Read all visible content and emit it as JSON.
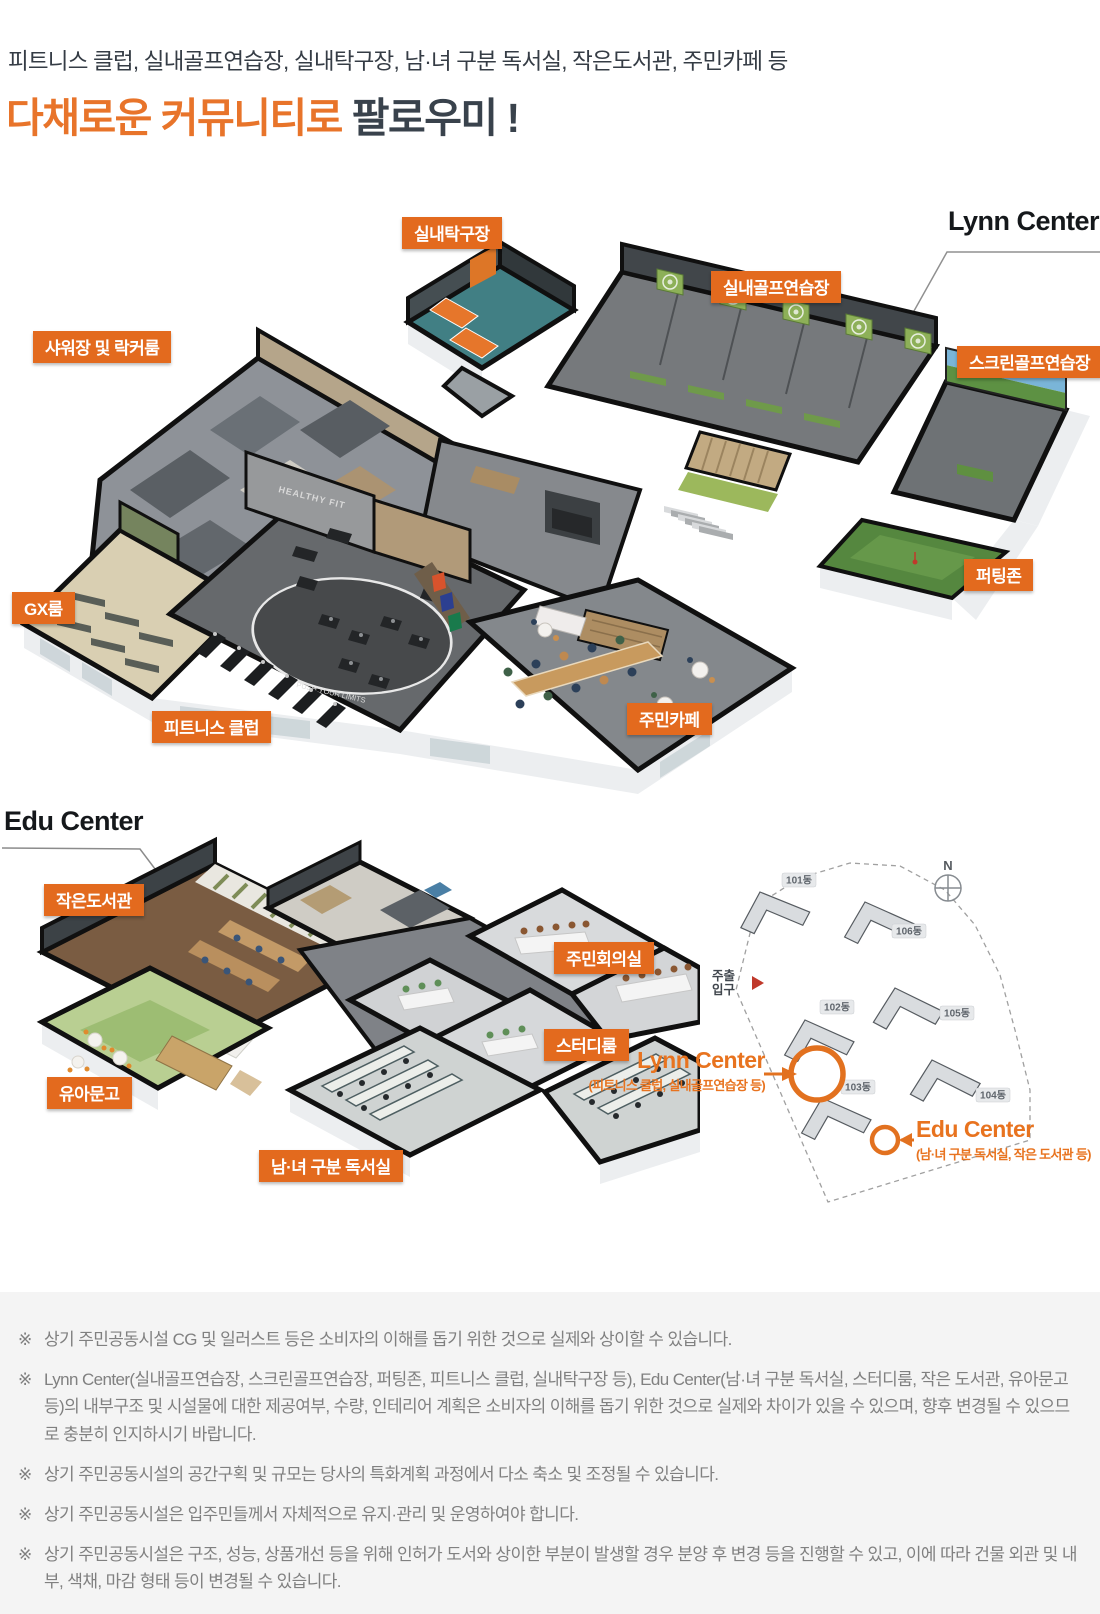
{
  "header": {
    "subtitle": "피트니스 클럽, 실내골프연습장, 실내탁구장, 남·녀 구분 독서실, 작은도서관, 주민카페 등",
    "title_orange": "다채로운 커뮤니티로",
    "title_dark": " 팔로우미 !"
  },
  "lynn_center": {
    "heading": "Lynn Center",
    "labels": {
      "table_tennis": "실내탁구장",
      "indoor_golf": "실내골프연습장",
      "screen_golf": "스크린골프연습장",
      "shower_locker": "샤워장 및 락커룸",
      "gx_room": "GX룸",
      "putting_zone": "퍼팅존",
      "fitness_club": "피트니스 클럽",
      "cafe": "주민카페"
    },
    "decor": {
      "gym_wall": "HEALTHY FIT",
      "track_text": "PUSH YOUR LIMITS"
    }
  },
  "edu_center": {
    "heading": "Edu Center",
    "labels": {
      "small_library": "작은도서관",
      "meeting_room": "주민회의실",
      "study_room": "스터디룸",
      "kids_library": "유아문고",
      "reading_room": "남·녀 구분 독서실"
    }
  },
  "site_plan": {
    "compass": "N",
    "main_entrance_line1": "주출",
    "main_entrance_line2": "입구",
    "buildings": [
      "101동",
      "102동",
      "103동",
      "104동",
      "105동",
      "106동"
    ],
    "lynn_annotation": {
      "title": "Lynn Center",
      "subtitle": "(피트니스 클럽, 실내골프연습장 등)"
    },
    "edu_annotation": {
      "title": "Edu Center",
      "subtitle": "(남·녀 구분 독서실, 작은 도서관 등)"
    }
  },
  "notes": {
    "marker": "※",
    "items": [
      "상기 주민공동시설 CG 및 일러스트 등은 소비자의 이해를 돕기 위한 것으로 실제와 상이할 수 있습니다.",
      "Lynn Center(실내골프연습장, 스크린골프연습장, 퍼팅존, 피트니스 클럽, 실내탁구장 등), Edu Center(남·녀 구분 독서실, 스터디룸, 작은 도서관, 유아문고 등)의 내부구조 및 시설물에 대한 제공여부, 수량, 인테리어 계획은 소비자의 이해를 돕기 위한 것으로 실제와 차이가 있을 수 있으며, 향후 변경될 수 있으므로 충분히 인지하시기 바랍니다.",
      "상기 주민공동시설의 공간구획 및 규모는 당사의 특화계획 과정에서 다소 축소 및 조정될 수 있습니다.",
      "상기 주민공동시설은 입주민들께서 자체적으로 유지·관리 및 운영하여야 합니다.",
      "상기 주민공동시설은 구조, 성능, 상품개선 등을 위해 인허가 도서와 상이한 부분이 발생할 경우 분양 후 변경 등을 진행할 수 있고, 이에 따라 건물 외관 및 내부, 색채, 마감 형태 등이 변경될 수 있습니다."
    ]
  }
}
